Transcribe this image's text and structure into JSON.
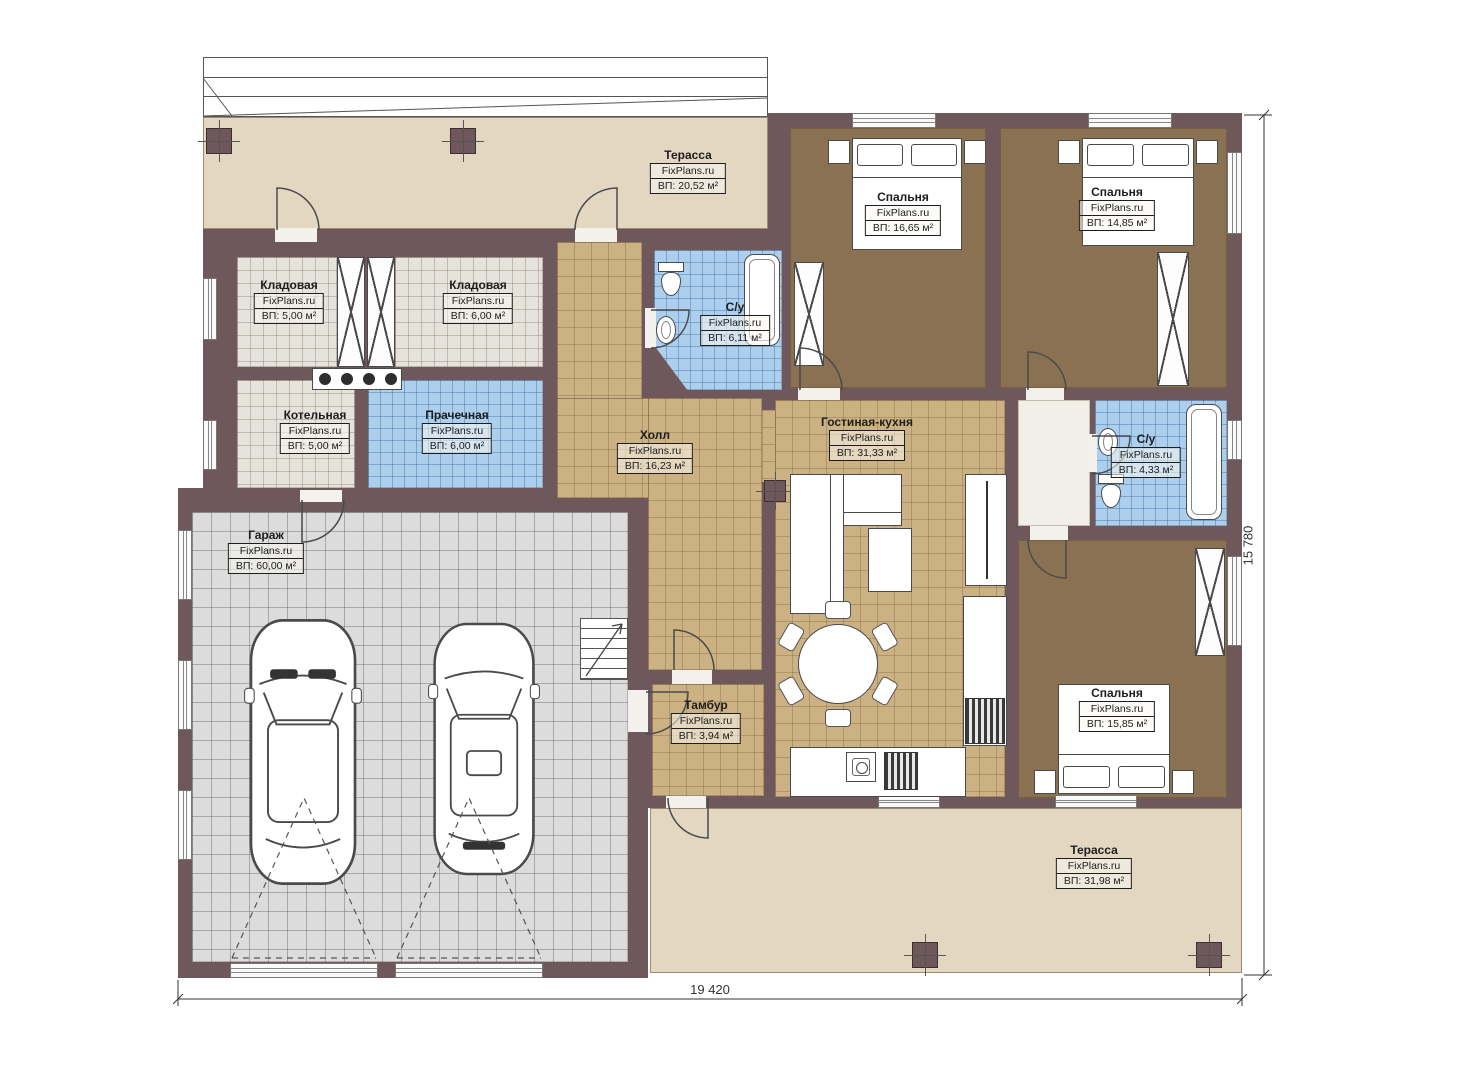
{
  "watermark": "FixPlans.ru",
  "rooms": [
    {
      "id": "terrace-top",
      "name": "Терасса",
      "area": "ВП: 20,52 м²"
    },
    {
      "id": "bedroom-1",
      "name": "Спальня",
      "area": "ВП: 16,65 м²"
    },
    {
      "id": "bedroom-2",
      "name": "Спальня",
      "area": "ВП: 14,85 м²"
    },
    {
      "id": "storage-1",
      "name": "Кладовая",
      "area": "ВП: 5,00 м²"
    },
    {
      "id": "storage-2",
      "name": "Кладовая",
      "area": "ВП: 6,00 м²"
    },
    {
      "id": "bathroom-1",
      "name": "С/у",
      "area": "ВП: 6,11 м²"
    },
    {
      "id": "boiler-room",
      "name": "Котельная",
      "area": "ВП: 5,00 м²"
    },
    {
      "id": "laundry",
      "name": "Прачечная",
      "area": "ВП: 6,00 м²"
    },
    {
      "id": "hall",
      "name": "Холл",
      "area": "ВП: 16,23 м²"
    },
    {
      "id": "living-kitchen",
      "name": "Гостиная-кухня",
      "area": "ВП: 31,33 м²"
    },
    {
      "id": "bathroom-2",
      "name": "С/у",
      "area": "ВП: 4,33 м²"
    },
    {
      "id": "garage",
      "name": "Гараж",
      "area": "ВП: 60,00 м²"
    },
    {
      "id": "vestibule",
      "name": "Тамбур",
      "area": "ВП: 3,94 м²"
    },
    {
      "id": "bedroom-3",
      "name": "Спальня",
      "area": "ВП: 15,85 м²"
    },
    {
      "id": "terrace-bottom",
      "name": "Терасса",
      "area": "ВП: 31,98 м²"
    }
  ],
  "dimensions": {
    "bottom": "19 420",
    "right": "15 780"
  },
  "colors": {
    "wall": "#6e585c",
    "terrace": "#e3d7c1",
    "floor_tan": "#ccb183",
    "floor_brown": "#8a7152",
    "tile_blue": "#abcfec",
    "garage_gray": "#dcdcdc",
    "utility_gray": "#e6e3dc"
  }
}
